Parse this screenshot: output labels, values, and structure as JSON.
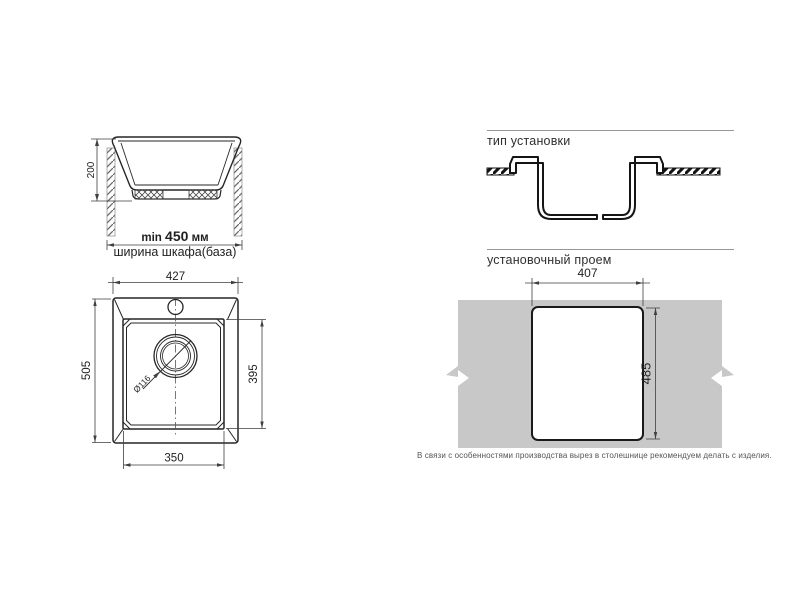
{
  "colors": {
    "line": "#262626",
    "dimension": "#3f3f3f",
    "countertop_gray": "#c8c8c8",
    "divider_gray": "#979797"
  },
  "cabinet_section": {
    "depth_dim": "200",
    "width_min_prefix": "min",
    "width_min_value": "450",
    "width_min_unit": "мм",
    "cabinet_label": "ширина шкафа(база)"
  },
  "install_type": {
    "title": "тип установки"
  },
  "top_view": {
    "overall_width": "427",
    "overall_height": "505",
    "bowl_height": "395",
    "bowl_width": "350",
    "drain_diameter": "Ø116"
  },
  "cutout": {
    "title": "установочный проем",
    "width": "407",
    "height": "485",
    "note": "В связи с особенностями производства вырез в столешнице рекомендуем делать с изделия."
  }
}
